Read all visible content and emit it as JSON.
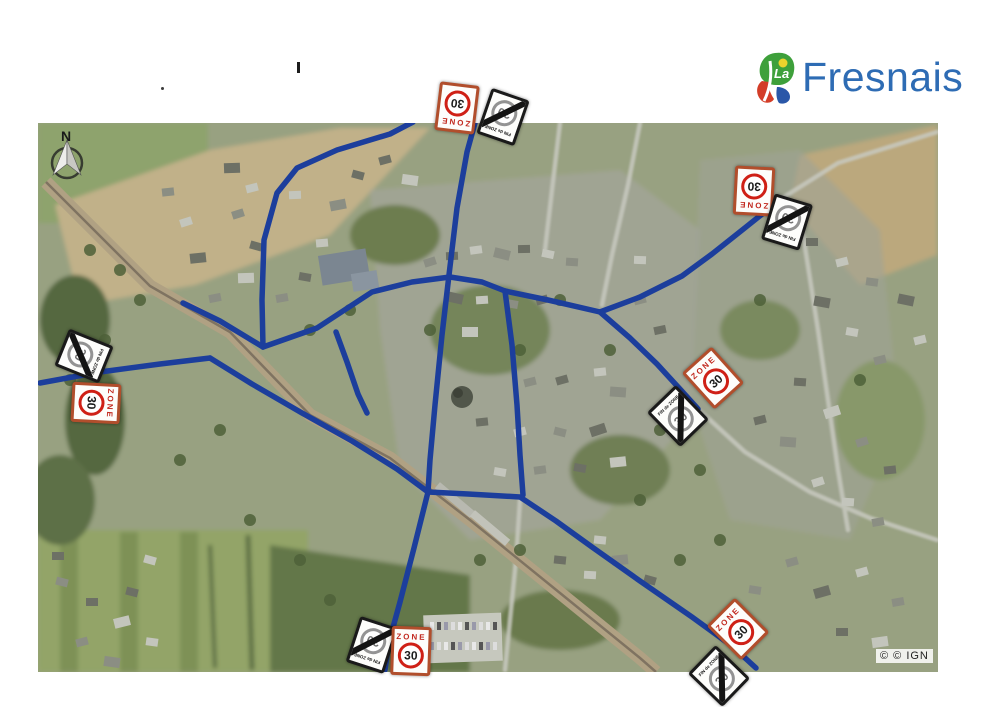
{
  "header": {
    "logo": {
      "la": "La",
      "name": "Fresnais",
      "text_color": "#2e6cb4"
    }
  },
  "map": {
    "north_label": "N",
    "attribution": "© © IGN",
    "road_color": "#1c3e9c",
    "sign_text": {
      "zone_word": "ZONE",
      "speed": "30",
      "fin_word": "FIN de ZONE"
    },
    "signs": [
      {
        "type": "zone",
        "x": 457,
        "y": 108,
        "rot": 187
      },
      {
        "type": "fin",
        "x": 503,
        "y": 117,
        "rot": 199
      },
      {
        "type": "zone",
        "x": 754,
        "y": 191,
        "rot": 183
      },
      {
        "type": "fin",
        "x": 787,
        "y": 222,
        "rot": 197
      },
      {
        "type": "fin",
        "x": 84,
        "y": 356,
        "rot": 112
      },
      {
        "type": "zone",
        "x": 96,
        "y": 403,
        "rot": 93
      },
      {
        "type": "zone",
        "x": 713,
        "y": 378,
        "rot": -42
      },
      {
        "type": "fin",
        "x": 678,
        "y": 416,
        "rot": -44
      },
      {
        "type": "fin",
        "x": 372,
        "y": 645,
        "rot": 198
      },
      {
        "type": "zone",
        "x": 411,
        "y": 651,
        "rot": 2
      },
      {
        "type": "zone",
        "x": 738,
        "y": 629,
        "rot": -45
      },
      {
        "type": "fin",
        "x": 719,
        "y": 676,
        "rot": -46
      }
    ],
    "roads": [
      {
        "name": "grande-rue-nord",
        "pts": [
          [
            475,
            123
          ],
          [
            467,
            152
          ],
          [
            457,
            208
          ],
          [
            449,
            275
          ],
          [
            442,
            335
          ],
          [
            435,
            405
          ],
          [
            430,
            460
          ],
          [
            428,
            492
          ]
        ]
      },
      {
        "name": "rue-sud",
        "pts": [
          [
            428,
            492
          ],
          [
            414,
            548
          ],
          [
            400,
            602
          ],
          [
            389,
            642
          ],
          [
            385,
            670
          ]
        ]
      },
      {
        "name": "rue-nord-ouest",
        "pts": [
          [
            413,
            122
          ],
          [
            390,
            134
          ],
          [
            337,
            150
          ],
          [
            297,
            168
          ],
          [
            277,
            193
          ],
          [
            264,
            240
          ],
          [
            262,
            300
          ],
          [
            263,
            347
          ]
        ]
      },
      {
        "name": "rue-de-la-gare",
        "pts": [
          [
            263,
            347
          ],
          [
            220,
            321
          ],
          [
            183,
            303
          ]
        ]
      },
      {
        "name": "rue-centrale",
        "pts": [
          [
            263,
            347
          ],
          [
            317,
            328
          ],
          [
            372,
            292
          ],
          [
            412,
            282
          ],
          [
            450,
            277
          ],
          [
            482,
            282
          ],
          [
            505,
            291
          ],
          [
            548,
            300
          ],
          [
            600,
            312
          ]
        ]
      },
      {
        "name": "impasse-centre",
        "pts": [
          [
            336,
            332
          ],
          [
            347,
            362
          ],
          [
            358,
            394
          ],
          [
            367,
            413
          ]
        ]
      },
      {
        "name": "rue-ouest",
        "pts": [
          [
            40,
            383
          ],
          [
            100,
            372
          ],
          [
            160,
            364
          ],
          [
            210,
            358
          ]
        ]
      },
      {
        "name": "rue-diagonale",
        "pts": [
          [
            210,
            358
          ],
          [
            252,
            384
          ],
          [
            302,
            413
          ],
          [
            352,
            441
          ],
          [
            397,
            469
          ],
          [
            428,
            492
          ]
        ]
      },
      {
        "name": "rue-est-gare",
        "pts": [
          [
            428,
            492
          ],
          [
            468,
            494
          ],
          [
            520,
            497
          ],
          [
            556,
            521
          ],
          [
            592,
            547
          ],
          [
            640,
            581
          ],
          [
            692,
            617
          ],
          [
            732,
            646
          ],
          [
            756,
            668
          ]
        ]
      },
      {
        "name": "rue-centre-sud",
        "pts": [
          [
            505,
            291
          ],
          [
            512,
            345
          ],
          [
            517,
            405
          ],
          [
            520,
            455
          ],
          [
            523,
            495
          ]
        ]
      },
      {
        "name": "route-nord-est",
        "pts": [
          [
            600,
            312
          ],
          [
            640,
            297
          ],
          [
            682,
            276
          ],
          [
            712,
            254
          ],
          [
            746,
            227
          ],
          [
            766,
            211
          ],
          [
            776,
            202
          ]
        ]
      },
      {
        "name": "route-sud-est",
        "pts": [
          [
            600,
            312
          ],
          [
            630,
            338
          ],
          [
            657,
            364
          ],
          [
            679,
            388
          ],
          [
            698,
            409
          ]
        ]
      }
    ],
    "railway": {
      "pts": [
        [
          46,
          182
        ],
        [
          150,
          286
        ],
        [
          230,
          332
        ],
        [
          310,
          415
        ],
        [
          390,
          458
        ],
        [
          470,
          520
        ],
        [
          560,
          593
        ],
        [
          640,
          658
        ],
        [
          656,
          672
        ]
      ]
    }
  }
}
